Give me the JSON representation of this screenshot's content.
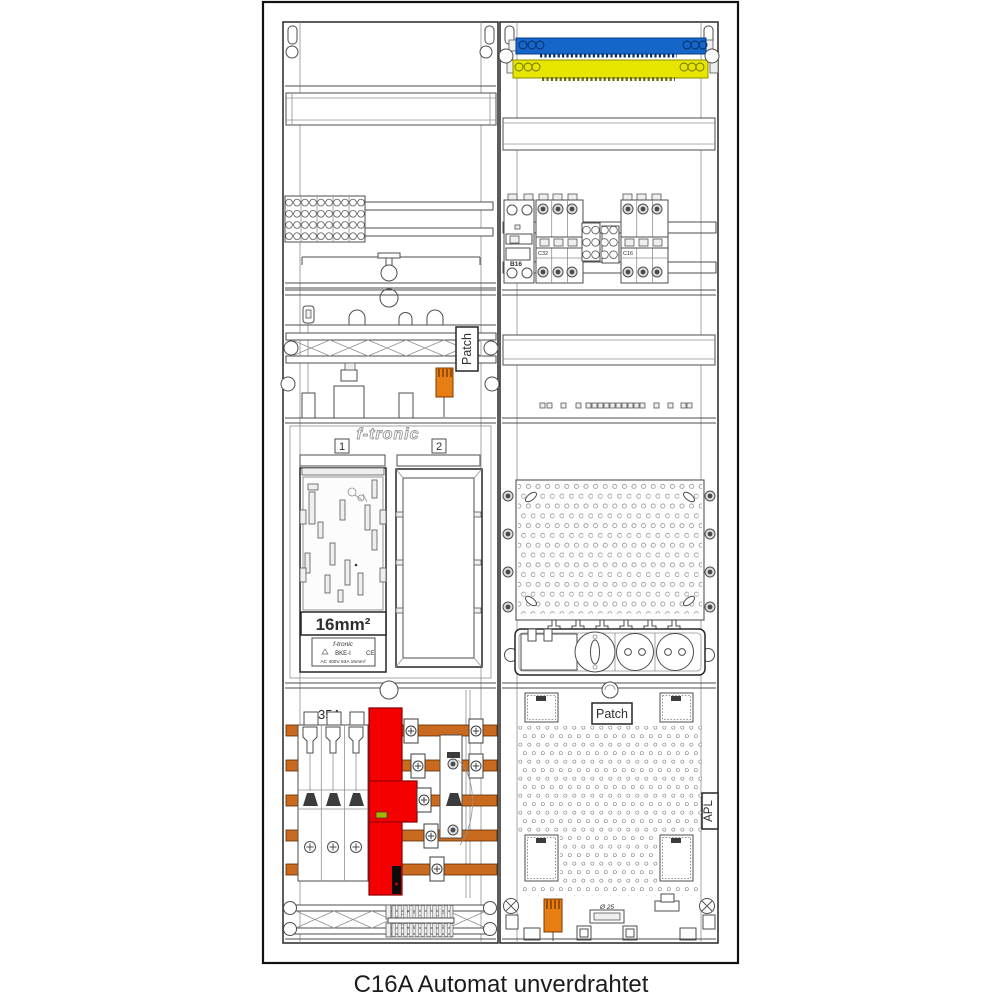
{
  "caption": "C16A Automat unverdrahtet",
  "colors": {
    "neutral_rail_blue": "#1467c8",
    "pe_rail_yellow": "#e6e600",
    "sls_cover_red": "#f40000",
    "component_orange": "#e87d14",
    "busbar_copper": "#c96a1e",
    "indicator_green": "#a8b400"
  },
  "left_field": {
    "patch_label": "Patch",
    "meter_area": {
      "brand": "f-tronic",
      "position_1": "1",
      "position_2": "2",
      "cross_section": "16mm²",
      "adapter_label": {
        "brand": "f-tronic",
        "model": "BKE-I",
        "ce_mark": "CE",
        "rating": "AC 400V   63A   16mm²"
      }
    },
    "sls_rating": "35A"
  },
  "right_field": {
    "rcbo_label": "B16",
    "mcb_left_label": "C32",
    "mcb_right_label": "C16",
    "patch_label": "Patch",
    "apl_label": "APL",
    "knockout_label": "Ø 25"
  }
}
